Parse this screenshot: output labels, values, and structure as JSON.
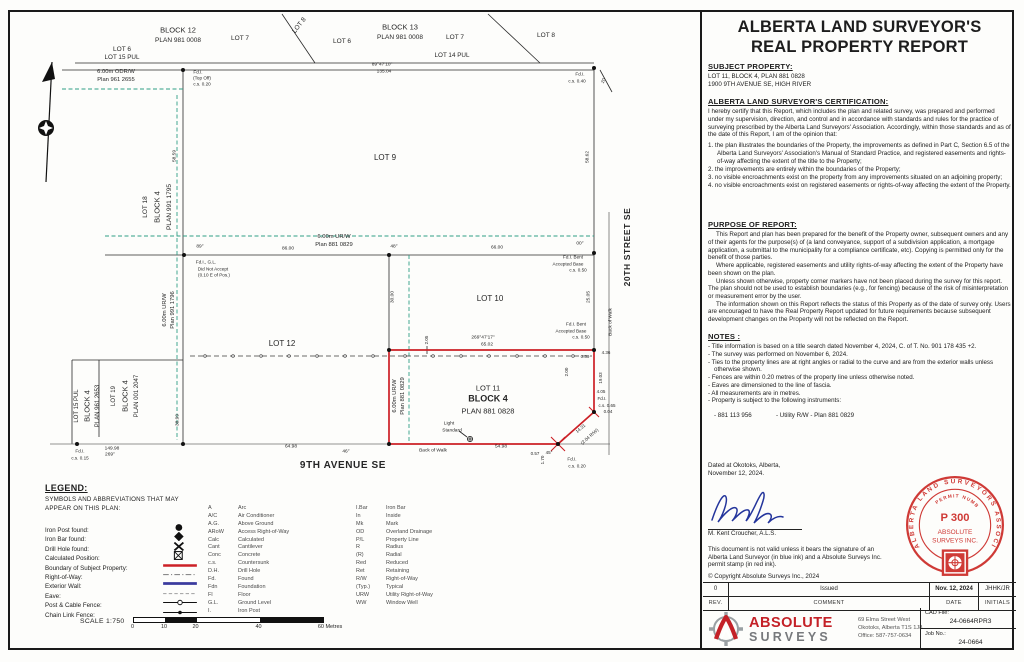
{
  "colors": {
    "boundary_red": "#cc2026",
    "urw_green": "#2f9e85",
    "stamp_red": "#cf3a36",
    "logo_red": "#c42127",
    "logo_gray": "#8a8d90",
    "signature_blue": "#24359c"
  },
  "report": {
    "title_line1": "ALBERTA LAND SURVEYOR'S",
    "title_line2": "REAL PROPERTY REPORT",
    "subject": {
      "heading": "SUBJECT PROPERTY:",
      "line1": "LOT 11, BLOCK 4, PLAN 881 0828",
      "line2": "1900 9TH AVENUE SE, HIGH RIVER"
    },
    "certification": {
      "heading": "ALBERTA LAND SURVEYOR'S CERTIFICATION:",
      "intro": "I hereby certify that this Report, which includes the plan and related survey, was prepared and performed under my supervision, direction, and control and in accordance with standards and rules for the practice of surveying prescribed by the Alberta Land Surveyors' Association. Accordingly, within those standards and as of the date of this Report, I am of the opinion that:",
      "items": [
        "the plan illustrates the boundaries of the Property, the improvements as defined in Part C, Section 6.5 of the Alberta Land Surveyors' Association's Manual of Standard Practice, and registered easements and rights-of-way affecting the extent of the title to the Property;",
        "the improvements are entirely within the boundaries of the Property;",
        "no visible encroachments exist on the property from any improvements situated on an adjoining property;",
        "no visible encroachments exist on registered easements or rights-of-way affecting the extent of the Property."
      ]
    },
    "purpose": {
      "heading": "PURPOSE OF REPORT:",
      "paragraphs": [
        "This Report and plan has been prepared for the benefit of the Property owner, subsequent owners and any of their agents for the purpose(s) of (a land conveyance, support of a subdivision application, a mortgage application, a submittal to the municipality for a compliance certificate, etc). Copying is permitted only for the benefit of those parties.",
        "Where applicable, registered easements and utility rights-of-way affecting the extent of the Property have been shown on the plan.",
        "Unless shown otherwise, property corner markers have not been placed during the survey for this report. The plan should not be used to establish boundaries (e.g., for fencing) because of the risk of misinterpretation or measurement error by the user.",
        "The information shown on this Report reflects the status of this Property as of the date of survey only. Users are encouraged to have the Real Property Report updated for future requirements because subsequent development changes on the Property will not be reflected on the Report."
      ]
    },
    "notes": {
      "heading": "NOTES :",
      "items": [
        "Title information is based on a title search dated November 4, 2024, C. of T. No. 901 178 435 +2.",
        "The survey was performed on November 6, 2024.",
        "Ties to the property lines are at right angles or radial to the curve and are from the exterior walls unless otherwise shown.",
        "Fences are within 0.20 metres of the property line unless otherwise noted.",
        "Eaves are dimensioned to the line of fascia.",
        "All measurements are in metres.",
        "Property is subject to the following instruments:"
      ],
      "instrument_number": "- 881 113 956",
      "instrument_desc": "- Utility R/W - Plan 881 0829"
    },
    "dated_line1": "Dated at Okotoks, Alberta,",
    "dated_line2": "November 12, 2024.",
    "surveyor": "M. Kent Croucher, A.L.S.",
    "validity": "This document is not valid unless it bears the signature of an Alberta Land Surveyor (in blue ink) and a Absolute Surveys Inc. permit stamp (in red ink).",
    "copyright": "© Copyright Absolute Surveys Inc., 2024",
    "stamp": {
      "ring": "ALBERTA LAND SURVEYORS ASSOCIATION",
      "permit_label": "PERMIT NUMBER",
      "permit_no": "P 300",
      "line1": "ABSOLUTE",
      "line2": "SURVEYS  INC."
    },
    "revisions": {
      "row": {
        "rev": "0",
        "comment": "Issued",
        "date": "Nov. 12, 2024",
        "initials": "JHHK/JR"
      },
      "headers": {
        "rev": "REV.",
        "comment": "COMMENT",
        "date": "DATE",
        "initials": "INITIALS"
      }
    },
    "firm": {
      "name1": "ABSOLUTE",
      "name2": "SURVEYS",
      "address1": "69 Elma Street West",
      "address2": "Okotoks, Alberta  T1S 1J8",
      "address3": "Office: 587-757-0634",
      "cad_label": "CAD File:",
      "cad_value": "24-0664RPR3",
      "job_label": "Job No.:",
      "job_value": "24-0664"
    }
  },
  "legend": {
    "heading": "LEGEND:",
    "subtitle1": "SYMBOLS AND ABBREVIATIONS THAT MAY",
    "subtitle2": "APPEAR ON THIS PLAN:",
    "rows": [
      {
        "label": "Iron Post found:",
        "sym": "iron-post"
      },
      {
        "label": "Iron Bar found:",
        "sym": "iron-bar"
      },
      {
        "label": "Drill Hole found:",
        "sym": "drill-hole"
      },
      {
        "label": "Calculated Position:",
        "sym": "calculated"
      },
      {
        "label": "Boundary of Subject Property:",
        "sym": "boundary"
      },
      {
        "label": "Right-of-Way:",
        "sym": "row"
      },
      {
        "label": "Exterior Wall:",
        "sym": "wall"
      },
      {
        "label": "Eave:",
        "sym": "eave"
      },
      {
        "label": "Post & Cable Fence:",
        "sym": "post-cable"
      },
      {
        "label": "Chain Link Fence:",
        "sym": "chain-link"
      }
    ],
    "abbreviations": {
      "col1": [
        [
          "A",
          "Arc"
        ],
        [
          "A/C",
          "Air Conditioner"
        ],
        [
          "A.G.",
          "Above Ground"
        ],
        [
          "ARoW",
          "Access Right-of-Way"
        ],
        [
          "Calc",
          "Calculated"
        ],
        [
          "Cant",
          "Cantilever"
        ],
        [
          "Conc",
          "Concrete"
        ],
        [
          "c.s.",
          "Countersunk"
        ],
        [
          "D.H.",
          "Drill Hole"
        ],
        [
          "Fd.",
          "Found"
        ],
        [
          "Fdn",
          "Foundation"
        ],
        [
          "Fl",
          "Floor"
        ],
        [
          "G.L.",
          "Ground Level"
        ],
        [
          "I.",
          "Iron Post"
        ]
      ],
      "col2": [
        [
          "I.Bar",
          "Iron Bar"
        ],
        [
          "In",
          "Inside"
        ],
        [
          "Mk",
          "Mark"
        ],
        [
          "OD",
          "Overland Drainage"
        ],
        [
          "P/L",
          "Property Line"
        ],
        [
          "R",
          "Radius"
        ],
        [
          "(R)",
          "Radial"
        ],
        [
          "Red",
          "Reduced"
        ],
        [
          "Ret",
          "Retaining"
        ],
        [
          "R/W",
          "Right-of-Way"
        ],
        [
          "(Typ.)",
          "Typical"
        ],
        [
          "URW",
          "Utility Right-of-Way"
        ],
        [
          "WW",
          "Window Well"
        ]
      ]
    }
  },
  "scalebar": {
    "label": "SCALE 1:750",
    "ticks": [
      "0",
      "10",
      "20",
      "40",
      "60 Metres"
    ]
  },
  "plan": {
    "street_south": "9TH AVENUE SE",
    "street_east": "20TH STREET SE",
    "labels": [
      {
        "t": "LOT 6",
        "x": 122,
        "y": 50,
        "s": 6.5
      },
      {
        "t": "BLOCK 12",
        "x": 178,
        "y": 30,
        "s": 7.5
      },
      {
        "t": "PLAN 981 0008",
        "x": 178,
        "y": 41,
        "s": 6.5
      },
      {
        "t": "LOT 7",
        "x": 240,
        "y": 39,
        "s": 6.5
      },
      {
        "t": "LOT 8",
        "x": 300,
        "y": 26,
        "r": -52,
        "s": 6.5
      },
      {
        "t": "LOT 6",
        "x": 342,
        "y": 42,
        "s": 6.5
      },
      {
        "t": "BLOCK 13",
        "x": 400,
        "y": 27,
        "s": 7.5
      },
      {
        "t": "PLAN 981 0008",
        "x": 400,
        "y": 38,
        "s": 6.5
      },
      {
        "t": "LOT 7",
        "x": 455,
        "y": 38,
        "s": 6.5
      },
      {
        "t": "LOT 8",
        "x": 546,
        "y": 36,
        "s": 6.5
      },
      {
        "t": "LOT 15 PUL",
        "x": 122,
        "y": 58,
        "s": 6.3
      },
      {
        "t": "LOT 14 PUL",
        "x": 452,
        "y": 56,
        "s": 6.3
      },
      {
        "t": "89°47'10\"",
        "x": 382,
        "y": 66,
        "s": 4.8
      },
      {
        "t": "135.04",
        "x": 384,
        "y": 73,
        "s": 4.8
      },
      {
        "t": "6.00m ODR/W",
        "x": 116,
        "y": 73,
        "s": 5.8,
        "c": "g"
      },
      {
        "t": "Plan 961 2655",
        "x": 116,
        "y": 81,
        "s": 5.8,
        "c": "g"
      },
      {
        "t": "Fd.I.",
        "x": 198,
        "y": 73,
        "s": 4.6
      },
      {
        "t": "(Top Off)",
        "x": 202,
        "y": 79,
        "s": 4.6
      },
      {
        "t": "c.s. 0.20",
        "x": 202,
        "y": 85,
        "s": 4.6
      },
      {
        "t": "Fd.I.",
        "x": 580,
        "y": 75,
        "s": 4.6
      },
      {
        "t": "c.s. 0.40",
        "x": 577,
        "y": 82,
        "s": 4.6
      },
      {
        "t": "20",
        "x": 604,
        "y": 81,
        "r": -65,
        "s": 4.6
      },
      {
        "t": "LOT 9",
        "x": 385,
        "y": 158,
        "s": 8
      },
      {
        "t": "58.59",
        "x": 176,
        "y": 156,
        "r": -90,
        "s": 4.8
      },
      {
        "t": "LOT 18",
        "x": 146,
        "y": 207,
        "r": -90,
        "s": 6.5
      },
      {
        "t": "BLOCK 4",
        "x": 157,
        "y": 207,
        "r": -90,
        "s": 7.5
      },
      {
        "t": "PLAN 991 1795",
        "x": 170,
        "y": 207,
        "r": -90,
        "s": 6.5
      },
      {
        "t": "58.62",
        "x": 589,
        "y": 157,
        "r": -90,
        "s": 4.8
      },
      {
        "t": "20TH STREET SE",
        "x": 627,
        "y": 247,
        "r": -90,
        "s": 8.5,
        "c": "b"
      },
      {
        "t": "89°",
        "x": 200,
        "y": 248,
        "s": 4.8
      },
      {
        "t": "86.00",
        "x": 288,
        "y": 250,
        "s": 4.8
      },
      {
        "t": "6.00m UR/W",
        "x": 334,
        "y": 238,
        "s": 5.8,
        "c": "g"
      },
      {
        "t": "Plan 881 0829",
        "x": 334,
        "y": 246,
        "s": 5.8,
        "c": "g"
      },
      {
        "t": "48°",
        "x": 394,
        "y": 248,
        "s": 4.8
      },
      {
        "t": "66.00",
        "x": 497,
        "y": 249,
        "s": 4.8
      },
      {
        "t": "00°",
        "x": 580,
        "y": 245,
        "s": 4.8
      },
      {
        "t": "Fd.I., G.L.",
        "x": 206,
        "y": 263,
        "s": 4.6
      },
      {
        "t": "Did Not Accept",
        "x": 213,
        "y": 269.5,
        "s": 4.6
      },
      {
        "t": "(0.10 E of Pos.)",
        "x": 214,
        "y": 276,
        "s": 4.6
      },
      {
        "t": "LOT 10",
        "x": 490,
        "y": 299,
        "s": 8
      },
      {
        "t": "Fd.I. Bent",
        "x": 573,
        "y": 258,
        "s": 4.6
      },
      {
        "t": "Accepted Base",
        "x": 568,
        "y": 264.5,
        "s": 4.6
      },
      {
        "t": "c.s. 0.50",
        "x": 578,
        "y": 271,
        "s": 4.6
      },
      {
        "t": "Fd.I. Bent",
        "x": 576,
        "y": 325,
        "s": 4.6
      },
      {
        "t": "Accepted Base",
        "x": 571,
        "y": 331.5,
        "s": 4.6
      },
      {
        "t": "c.s. 0.50",
        "x": 581,
        "y": 338,
        "s": 4.6
      },
      {
        "t": "30.00",
        "x": 394,
        "y": 297,
        "r": -90,
        "s": 4.8
      },
      {
        "t": "25.05",
        "x": 590,
        "y": 297,
        "r": -90,
        "s": 4.8
      },
      {
        "t": "Back of Walk",
        "x": 612,
        "y": 322,
        "r": -90,
        "s": 4.8
      },
      {
        "t": "269°47'17\"",
        "x": 483,
        "y": 339,
        "s": 4.8
      },
      {
        "t": "65.02",
        "x": 487,
        "y": 346,
        "s": 4.8
      },
      {
        "t": "2.05",
        "x": 427,
        "y": 340,
        "r": -90,
        "s": 4.5
      },
      {
        "t": "4.36",
        "x": 606,
        "y": 353,
        "s": 4.5
      },
      {
        "t": "0.39",
        "x": 585,
        "y": 357,
        "s": 4.5
      },
      {
        "t": "2.00",
        "x": 567,
        "y": 372,
        "r": -90,
        "s": 4.5
      },
      {
        "t": "19.03",
        "x": 601,
        "y": 378,
        "r": -90,
        "s": 4.5
      },
      {
        "t": "4.05",
        "x": 601,
        "y": 392,
        "s": 4.5
      },
      {
        "t": "Fd.I.",
        "x": 602,
        "y": 399,
        "s": 4.5
      },
      {
        "t": "c.s. 0.65",
        "x": 607,
        "y": 405.5,
        "s": 4.5
      },
      {
        "t": "0.04",
        "x": 608,
        "y": 412,
        "s": 4.5
      },
      {
        "t": "LOT 11",
        "x": 488,
        "y": 388,
        "s": 7.5,
        "c": "r"
      },
      {
        "t": "BLOCK 4",
        "x": 488,
        "y": 399,
        "s": 9,
        "c": "rb"
      },
      {
        "t": "PLAN 881 0828",
        "x": 488,
        "y": 411,
        "s": 7.5,
        "c": "r"
      },
      {
        "t": "6.00m UR/W",
        "x": 396,
        "y": 396,
        "r": -90,
        "s": 5.8,
        "c": "g"
      },
      {
        "t": "Plan 881 0829",
        "x": 404,
        "y": 396,
        "r": -90,
        "s": 5.8,
        "c": "g"
      },
      {
        "t": "LOT 12",
        "x": 282,
        "y": 344,
        "s": 8
      },
      {
        "t": "6.00m UR/W",
        "x": 166,
        "y": 310,
        "r": -90,
        "s": 5.8,
        "c": "g"
      },
      {
        "t": "Plan 991 1796",
        "x": 174,
        "y": 310,
        "r": -90,
        "s": 5.8,
        "c": "g"
      },
      {
        "t": "38.99",
        "x": 179,
        "y": 420,
        "r": -90,
        "s": 4.8
      },
      {
        "t": "LOT 15 PUL",
        "x": 77,
        "y": 406,
        "r": -90,
        "s": 6
      },
      {
        "t": "BLOCK 4",
        "x": 87,
        "y": 406,
        "r": -90,
        "s": 7.5
      },
      {
        "t": "PLAN 961 2653",
        "x": 98,
        "y": 406,
        "r": -90,
        "s": 6
      },
      {
        "t": "LOT 19",
        "x": 114,
        "y": 396,
        "r": -90,
        "s": 6
      },
      {
        "t": "BLOCK 4",
        "x": 125,
        "y": 396,
        "r": -90,
        "s": 7.5
      },
      {
        "t": "PLAN 001 2047",
        "x": 137,
        "y": 396,
        "r": -90,
        "s": 6
      },
      {
        "t": "Fd.I.",
        "x": 80,
        "y": 452,
        "s": 4.6
      },
      {
        "t": "c.s. 0.15",
        "x": 80,
        "y": 458.5,
        "s": 4.6
      },
      {
        "t": "149.98",
        "x": 112,
        "y": 450,
        "s": 4.8
      },
      {
        "t": "269°",
        "x": 110,
        "y": 456,
        "s": 4.8
      },
      {
        "t": "64.98",
        "x": 291,
        "y": 448,
        "s": 4.8
      },
      {
        "t": "46°",
        "x": 346,
        "y": 453,
        "s": 4.8
      },
      {
        "t": "Light",
        "x": 449,
        "y": 425,
        "s": 4.8
      },
      {
        "t": "Standard",
        "x": 452,
        "y": 431.5,
        "s": 4.8
      },
      {
        "t": "Back of Walk",
        "x": 433,
        "y": 452,
        "s": 4.8
      },
      {
        "t": "54.98",
        "x": 501,
        "y": 448,
        "s": 4.8
      },
      {
        "t": "9TH AVENUE SE",
        "x": 343,
        "y": 466,
        "s": 10,
        "c": "b"
      },
      {
        "t": "45°",
        "x": 549,
        "y": 453,
        "s": 4.5
      },
      {
        "t": "1.70",
        "x": 543,
        "y": 460,
        "r": -90,
        "s": 4.5
      },
      {
        "t": "0.57",
        "x": 535,
        "y": 454,
        "s": 4.5
      },
      {
        "t": "Fd.I.",
        "x": 572,
        "y": 460,
        "s": 4.6
      },
      {
        "t": "c.s. 0.20",
        "x": 577,
        "y": 467,
        "s": 4.6
      },
      {
        "t": "14.31",
        "x": 581,
        "y": 429,
        "r": -41,
        "s": 4.5
      },
      {
        "t": "(2.04 R/W)",
        "x": 590,
        "y": 437,
        "r": -41,
        "s": 4.5
      }
    ]
  }
}
